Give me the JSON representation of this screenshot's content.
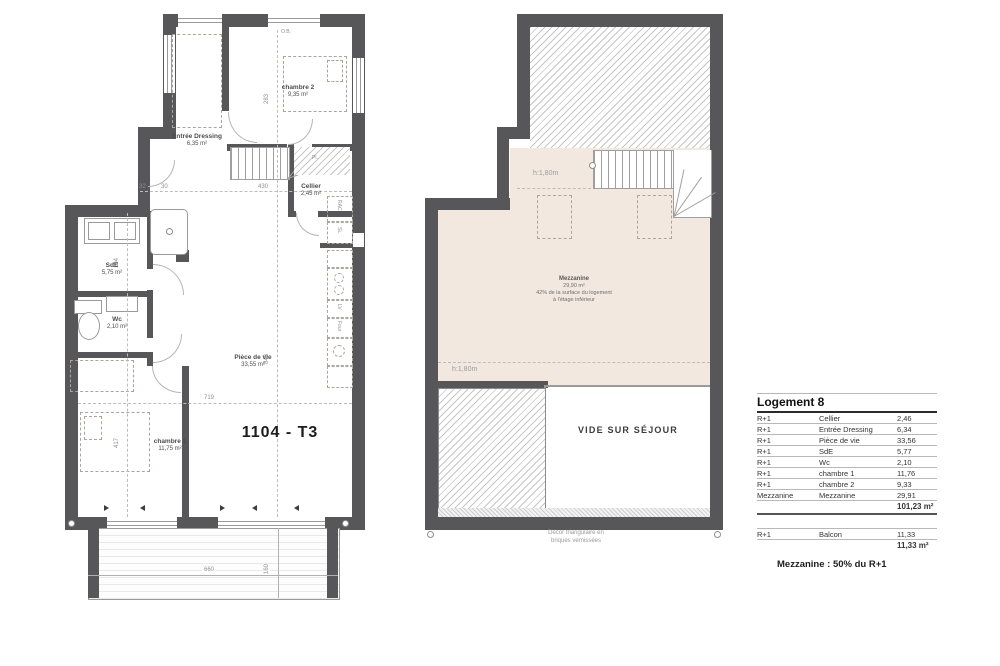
{
  "plan_left": {
    "title": "1104 - T3",
    "window_label": "O.B.",
    "closet_label": "Pl.",
    "rooms": {
      "chambre2": {
        "name": "chambre 2",
        "area": "9,35 m²"
      },
      "entree": {
        "name": "Entrée Dressing",
        "area": "6,35 m²"
      },
      "cellier": {
        "name": "Cellier",
        "area": "2,45 m²"
      },
      "sde": {
        "name": "SdE",
        "area": "5,75 m²"
      },
      "wc": {
        "name": "Wc",
        "area": "2,10 m²"
      },
      "chambre1": {
        "name": "chambre 1",
        "area": "11,75 m²"
      },
      "piece_de_vie": {
        "name": "Pièce de vie",
        "area": "33,55 m²"
      }
    },
    "kitchen_labels": {
      "rac": "RAC",
      "sl": "SL",
      "lv": "LV",
      "four": "Four"
    },
    "dims": {
      "w430": "430",
      "h283": "283",
      "w719": "719",
      "h417": "417",
      "h843": "843",
      "w660": "660",
      "h160": "160",
      "h194": "194",
      "w32": "32",
      "w30": "30"
    }
  },
  "plan_right": {
    "mezzanine": {
      "name": "Mezzanine",
      "area": "29,90 m²",
      "note_line1": "42% de la surface du logement",
      "note_line2": "à l'étage inférieur"
    },
    "height_top": "h:1,80m",
    "height_bottom": "h:1,80m",
    "vide": "VIDE SUR SÉJOUR",
    "footnote_line1": "Décor triangulaire en",
    "footnote_line2": "briques vernissées"
  },
  "summary_table": {
    "title": "Logement 8",
    "rows": [
      {
        "level": "R+1",
        "room": "Cellier",
        "area": "2,46"
      },
      {
        "level": "R+1",
        "room": "Entrée Dressing",
        "area": "6,34"
      },
      {
        "level": "R+1",
        "room": "Pièce de vie",
        "area": "33,56"
      },
      {
        "level": "R+1",
        "room": "SdE",
        "area": "5,77"
      },
      {
        "level": "R+1",
        "room": "Wc",
        "area": "2,10"
      },
      {
        "level": "R+1",
        "room": "chambre 1",
        "area": "11,76"
      },
      {
        "level": "R+1",
        "room": "chambre 2",
        "area": "9,33"
      },
      {
        "level": "Mezzanine",
        "room": "Mezzanine",
        "area": "29,91"
      }
    ],
    "total_main": "101,23 m²",
    "balcon_row": {
      "level": "R+1",
      "room": "Balcon",
      "area": "11,33"
    },
    "total_balcon": "11,33 m²",
    "note": "Mezzanine : 50% du R+1"
  },
  "colors": {
    "wall": "#57575a",
    "mezzanine_fill": "#f2e8e0"
  }
}
